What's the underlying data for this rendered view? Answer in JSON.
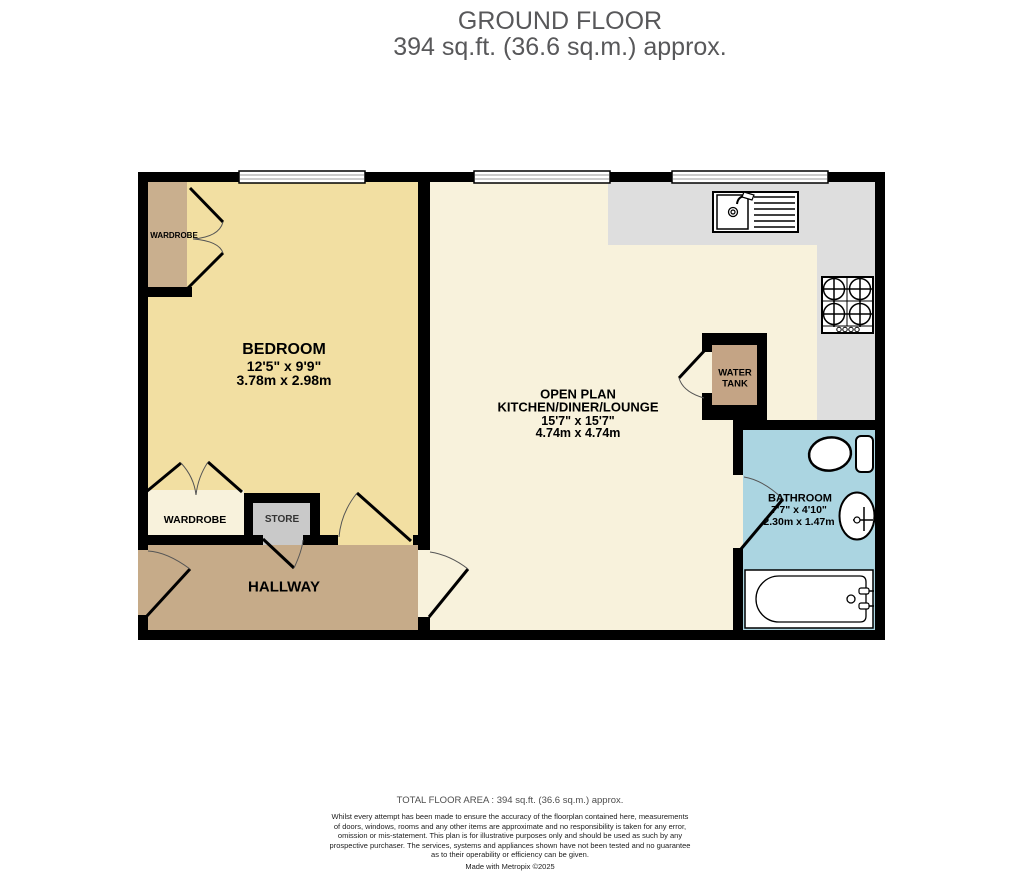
{
  "title": {
    "line1": "GROUND FLOOR",
    "line2": "394 sq.ft. (36.6 sq.m.) approx."
  },
  "rooms": {
    "bedroom": {
      "name": "BEDROOM",
      "dims_ft": "12'5\"  x 9'9\"",
      "dims_m": "3.78m  x 2.98m"
    },
    "open_plan": {
      "line1": "OPEN PLAN",
      "line2": "KITCHEN/DINER/LOUNGE",
      "dims_ft": "15'7\"  x 15'7\"",
      "dims_m": "4.74m  x 4.74m"
    },
    "bathroom": {
      "name": "BATHROOM",
      "dims_ft": "7'7\"  x 4'10\"",
      "dims_m": "2.30m  x 1.47m"
    },
    "hallway": {
      "name": "HALLWAY"
    },
    "wardrobe_bedroom_top": {
      "name": "WARDROBE"
    },
    "wardrobe_bedroom_bottom": {
      "name": "WARDROBE"
    },
    "store": {
      "name": "STORE"
    },
    "water_tank": {
      "line1": "WATER",
      "line2": "TANK"
    }
  },
  "footer": {
    "total": "TOTAL FLOOR AREA : 394 sq.ft. (36.6 sq.m.) approx.",
    "disclaimer": [
      "Whilst every attempt has been made to ensure the accuracy of the floorplan contained here, measurements",
      "of doors, windows, rooms and any other items are approximate and no responsibility is taken for any error,",
      "omission or mis-statement. This plan is for illustrative purposes only and should be used as such by any",
      "prospective purchaser. The services, systems and appliances shown have not been tested and no guarantee",
      "as to their operability or efficiency can be given."
    ],
    "credit": "Made with Metropix ©2025"
  },
  "colors": {
    "bedroom_floor": "#F2DFA2",
    "open_plan_floor": "#F8F2DC",
    "hallway_floor": "#C6AB89",
    "wardrobe_fill": "#C9AF8E",
    "water_tank_fill": "#C4A485",
    "store_fill": "#C9C9C9",
    "bathroom_floor": "#ABD5E1",
    "counter_fill": "#DEDEDE",
    "wall": "#000000",
    "fixture_fill": "#FFFFFF"
  }
}
